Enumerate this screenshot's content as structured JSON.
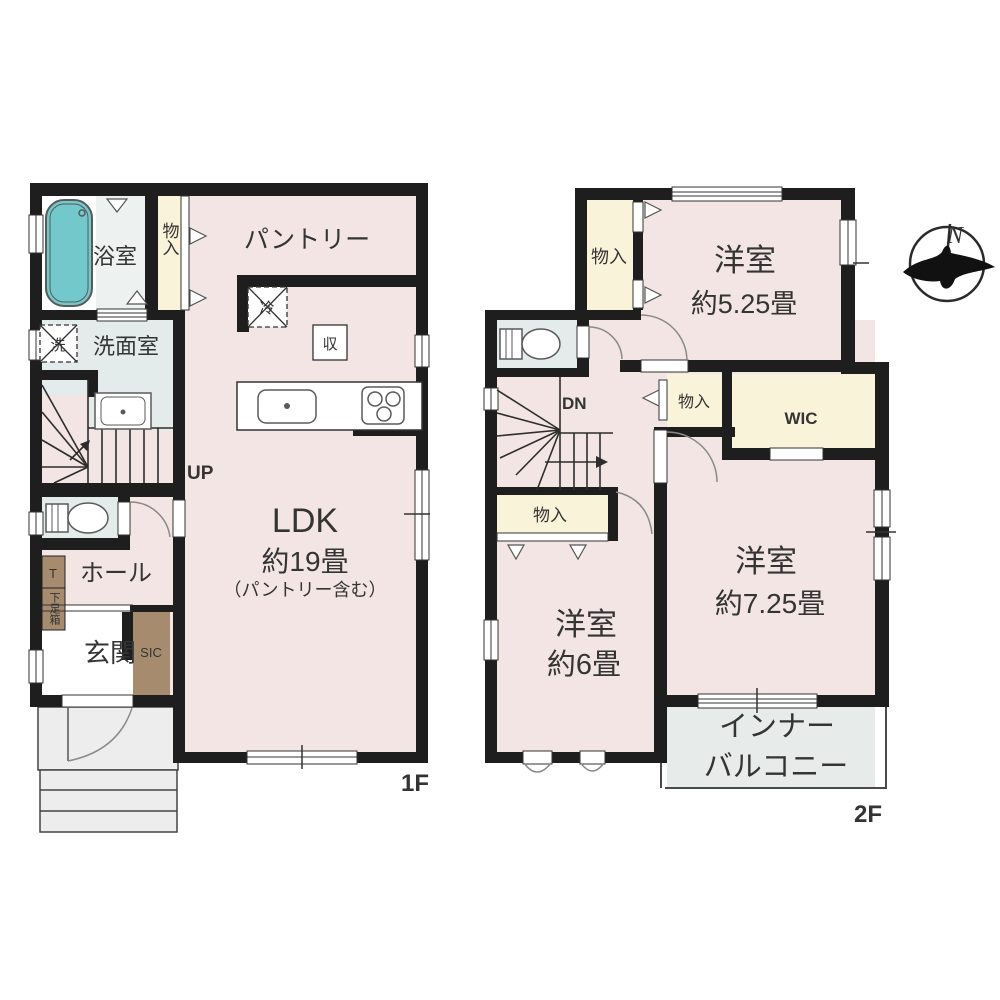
{
  "compass": {
    "north": "N"
  },
  "floor1": {
    "label": "1F",
    "bathroom": "浴室",
    "closet_top": "物入",
    "pantry": "パントリー",
    "laundry": "洗",
    "washroom": "洗面室",
    "fridge": "冷",
    "storage": "収",
    "stairs": "UP",
    "hall": "ホール",
    "shoe_t": "T",
    "shoe_cabinet": "下足箱",
    "entrance": "玄関",
    "sic": "SIC",
    "ldk_name": "LDK",
    "ldk_size": "約19畳",
    "ldk_note": "（パントリー含む）"
  },
  "floor2": {
    "label": "2F",
    "closet_a": "物入",
    "bedroom1_name": "洋室",
    "bedroom1_size": "約5.25畳",
    "stairs": "DN",
    "closet_b": "物入",
    "wic": "WIC",
    "bedroom2_name": "洋室",
    "bedroom2_size": "約7.25畳",
    "closet_c": "物入",
    "bedroom3_name": "洋室",
    "bedroom3_size": "約6畳",
    "balcony_line1": "インナー",
    "balcony_line2": "バルコニー"
  },
  "colors": {
    "room_pink": "#f2e5e3",
    "closet_cream": "#f9f4d9",
    "wet_blue": "#e4eceb",
    "bathtub_teal": "#72c8ca",
    "wood_brown": "#a78b6f",
    "balcony_grey": "#e7ebea",
    "wall_black": "#1e1e1e"
  }
}
